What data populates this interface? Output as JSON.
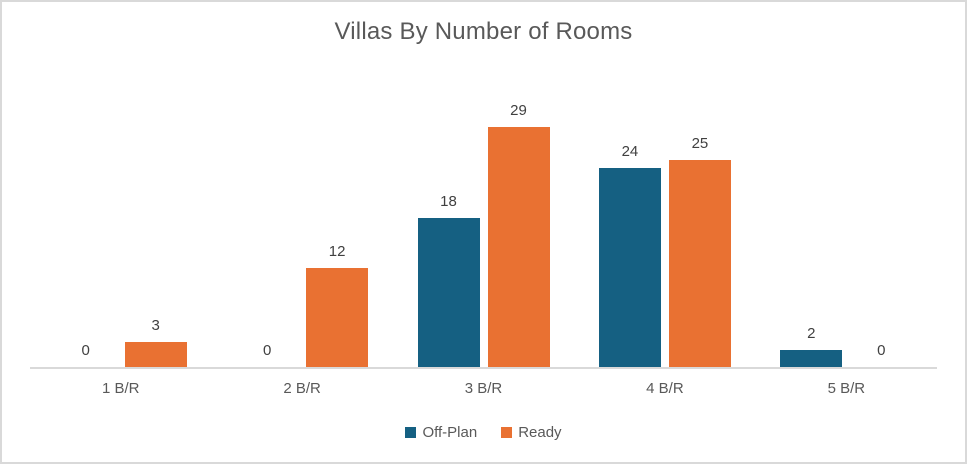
{
  "frame": {
    "border_color": "#D9D9D9",
    "background_color": "#FFFFFF",
    "axis_line_color": "#D9D9D9",
    "title_color": "#595959",
    "data_label_color": "#404040",
    "category_label_color": "#595959",
    "legend_label_color": "#595959"
  },
  "chart_data": {
    "type": "bar",
    "title": "Villas By Number of Rooms",
    "categories": [
      "1 B/R",
      "2 B/R",
      "3 B/R",
      "4 B/R",
      "5 B/R"
    ],
    "series": [
      {
        "name": "Off-Plan",
        "color": "#156082",
        "values": [
          0,
          0,
          18,
          24,
          2
        ]
      },
      {
        "name": "Ready",
        "color": "#E97132",
        "values": [
          3,
          12,
          29,
          25,
          0
        ]
      }
    ],
    "xlabel": "",
    "ylabel": "",
    "ylim": [
      0,
      35
    ],
    "gridlines": false,
    "y_axis_visible": false,
    "data_labels": "outside-end",
    "legend_position": "bottom"
  }
}
